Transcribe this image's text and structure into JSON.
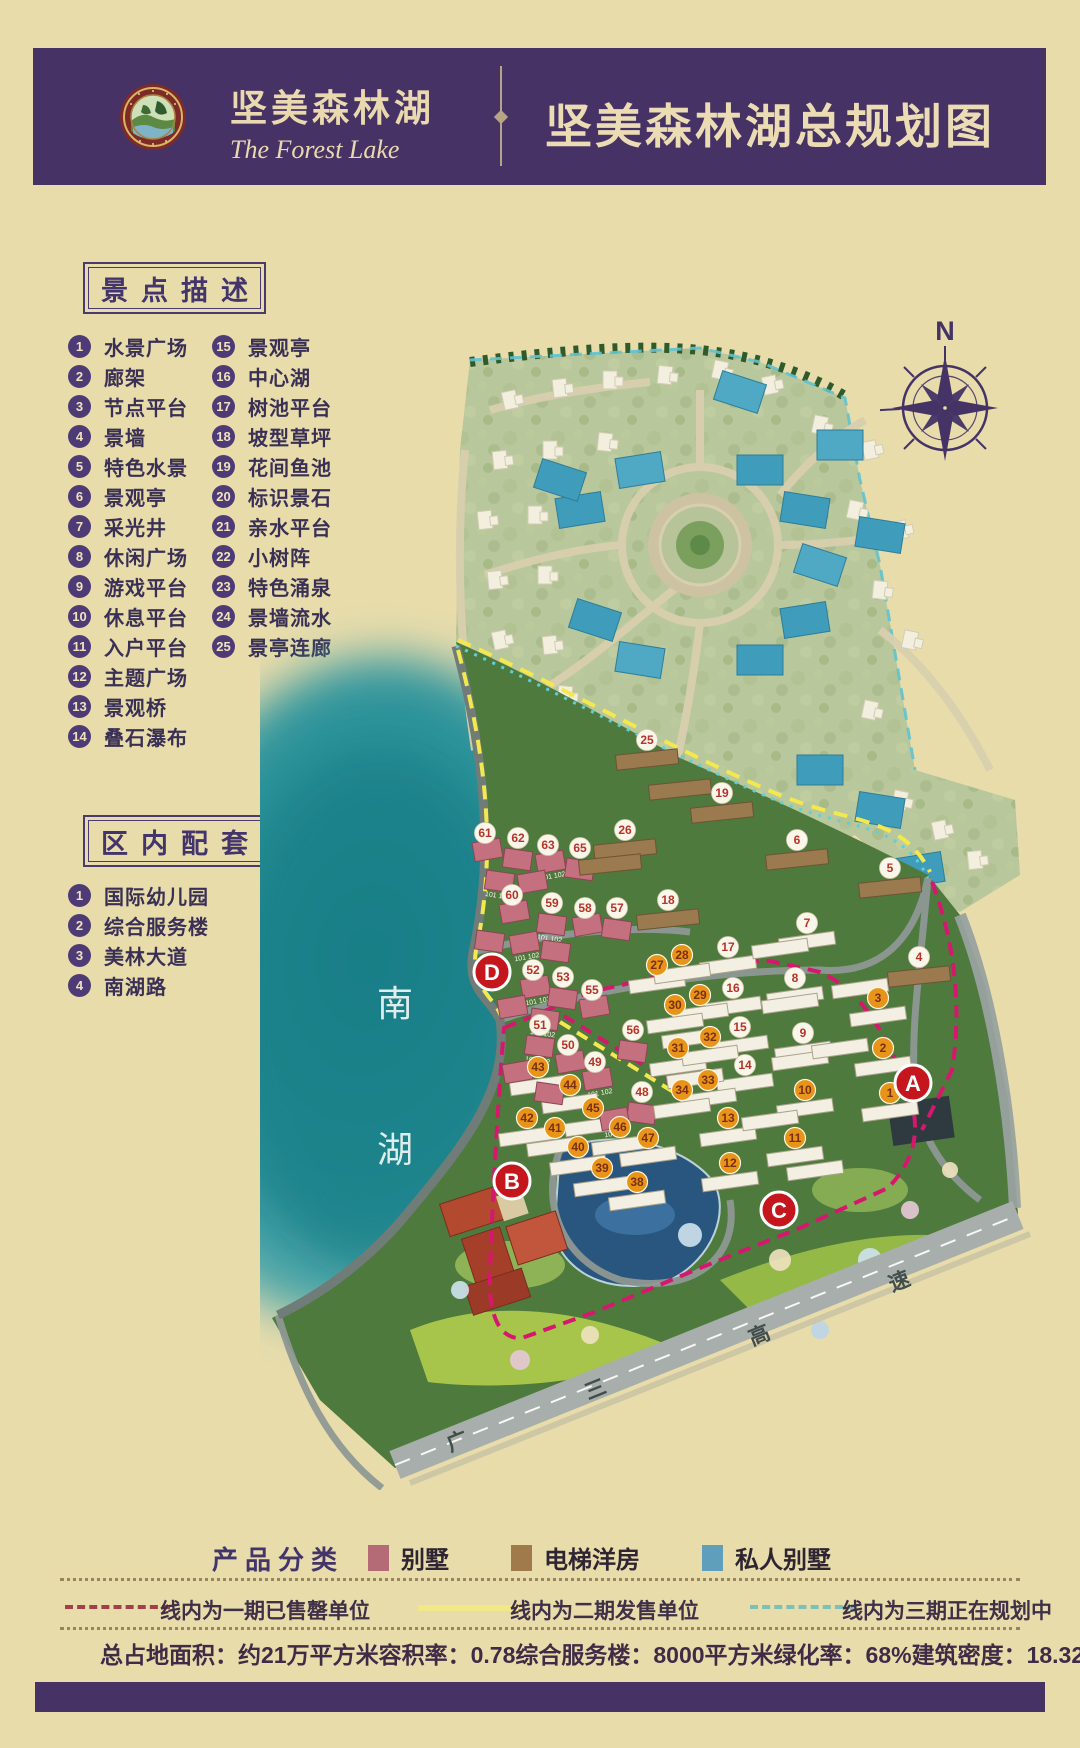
{
  "header": {
    "brand_cn": "坚美森林湖",
    "brand_en": "The Forest Lake",
    "title": "坚美森林湖总规划图"
  },
  "compass": {
    "north_label": "N"
  },
  "scenic": {
    "title": "景点描述",
    "items": [
      {
        "num": "1",
        "label": "水景广场"
      },
      {
        "num": "2",
        "label": "廊架"
      },
      {
        "num": "3",
        "label": "节点平台"
      },
      {
        "num": "4",
        "label": "景墙"
      },
      {
        "num": "5",
        "label": "特色水景"
      },
      {
        "num": "6",
        "label": "景观亭"
      },
      {
        "num": "7",
        "label": "采光井"
      },
      {
        "num": "8",
        "label": "休闲广场"
      },
      {
        "num": "9",
        "label": "游戏平台"
      },
      {
        "num": "10",
        "label": "休息平台"
      },
      {
        "num": "11",
        "label": "入户平台"
      },
      {
        "num": "12",
        "label": "主题广场"
      },
      {
        "num": "13",
        "label": "景观桥"
      },
      {
        "num": "14",
        "label": "叠石瀑布"
      },
      {
        "num": "15",
        "label": "景观亭"
      },
      {
        "num": "16",
        "label": "中心湖"
      },
      {
        "num": "17",
        "label": "树池平台"
      },
      {
        "num": "18",
        "label": "坡型草坪"
      },
      {
        "num": "19",
        "label": "花间鱼池"
      },
      {
        "num": "20",
        "label": "标识景石"
      },
      {
        "num": "21",
        "label": "亲水平台"
      },
      {
        "num": "22",
        "label": "小树阵"
      },
      {
        "num": "23",
        "label": "特色涌泉"
      },
      {
        "num": "24",
        "label": "景墙流水"
      },
      {
        "num": "25",
        "label": "景亭连廊"
      }
    ]
  },
  "amenities": {
    "title": "区内配套",
    "items": [
      {
        "num": "1",
        "label": "国际幼儿园"
      },
      {
        "num": "2",
        "label": "综合服务楼"
      },
      {
        "num": "3",
        "label": "美林大道"
      },
      {
        "num": "4",
        "label": "南湖路"
      }
    ]
  },
  "map": {
    "lake_labels": [
      {
        "char": "南",
        "x": 135,
        "y": 686
      },
      {
        "char": "湖",
        "x": 135,
        "y": 832
      }
    ],
    "highway_labels": [
      {
        "char": "广",
        "x": 200,
        "y": 1118,
        "rot": -22
      },
      {
        "char": "三",
        "x": 338,
        "y": 1066,
        "rot": -22
      },
      {
        "char": "高",
        "x": 502,
        "y": 1012,
        "rot": -22
      },
      {
        "char": "速",
        "x": 642,
        "y": 958,
        "rot": -22
      }
    ],
    "markers": [
      {
        "label": "A",
        "x": 653,
        "y": 753
      },
      {
        "label": "B",
        "x": 252,
        "y": 851
      },
      {
        "label": "C",
        "x": 519,
        "y": 880
      },
      {
        "label": "D",
        "x": 232,
        "y": 642
      }
    ],
    "pink_unit_labels": [
      "101",
      "102"
    ],
    "unit_badges_white": [
      {
        "n": "25",
        "x": 387,
        "y": 410,
        "b": "brown"
      },
      {
        "n": "19",
        "x": 462,
        "y": 463,
        "b": "brown"
      },
      {
        "n": "26",
        "x": 365,
        "y": 500,
        "b": "brown"
      },
      {
        "n": "6",
        "x": 537,
        "y": 510,
        "b": "brown"
      },
      {
        "n": "5",
        "x": 630,
        "y": 538,
        "b": "brown"
      },
      {
        "n": "18",
        "x": 408,
        "y": 570,
        "b": "brown"
      },
      {
        "n": "4",
        "x": 659,
        "y": 627,
        "b": "brown"
      },
      {
        "n": "61",
        "x": 225,
        "y": 503,
        "b": "pink"
      },
      {
        "n": "62",
        "x": 258,
        "y": 508,
        "b": "pink"
      },
      {
        "n": "63",
        "x": 288,
        "y": 515,
        "b": "pink"
      },
      {
        "n": "65",
        "x": 320,
        "y": 518,
        "b": "pink"
      },
      {
        "n": "60",
        "x": 252,
        "y": 565,
        "b": "pink"
      },
      {
        "n": "59",
        "x": 292,
        "y": 573,
        "b": "pink"
      },
      {
        "n": "58",
        "x": 325,
        "y": 578,
        "b": "pink"
      },
      {
        "n": "57",
        "x": 357,
        "y": 578,
        "b": "pink"
      },
      {
        "n": "52",
        "x": 273,
        "y": 640,
        "b": "pink"
      },
      {
        "n": "53",
        "x": 303,
        "y": 647,
        "b": "pink"
      },
      {
        "n": "55",
        "x": 332,
        "y": 660,
        "b": "pink"
      },
      {
        "n": "51",
        "x": 280,
        "y": 695,
        "b": "pink"
      },
      {
        "n": "50",
        "x": 308,
        "y": 715,
        "b": "pink"
      },
      {
        "n": "56",
        "x": 373,
        "y": 700,
        "b": "pink"
      },
      {
        "n": "49",
        "x": 335,
        "y": 732,
        "b": "pink"
      },
      {
        "n": "48",
        "x": 382,
        "y": 762,
        "b": "pink"
      },
      {
        "n": "17",
        "x": 468,
        "y": 617,
        "b": "white"
      },
      {
        "n": "16",
        "x": 473,
        "y": 658,
        "b": "white"
      },
      {
        "n": "15",
        "x": 480,
        "y": 697,
        "b": "white"
      },
      {
        "n": "14",
        "x": 485,
        "y": 735,
        "b": "white"
      },
      {
        "n": "7",
        "x": 547,
        "y": 593,
        "b": "white"
      },
      {
        "n": "8",
        "x": 535,
        "y": 648,
        "b": "white"
      },
      {
        "n": "9",
        "x": 543,
        "y": 703,
        "b": "white"
      }
    ],
    "unit_badges_orange": [
      {
        "n": "27",
        "x": 397,
        "y": 635,
        "b": "white"
      },
      {
        "n": "28",
        "x": 422,
        "y": 625,
        "b": "white"
      },
      {
        "n": "29",
        "x": 440,
        "y": 665,
        "b": "white"
      },
      {
        "n": "30",
        "x": 415,
        "y": 675,
        "b": "white"
      },
      {
        "n": "31",
        "x": 418,
        "y": 718,
        "b": "white"
      },
      {
        "n": "32",
        "x": 450,
        "y": 707,
        "b": "white"
      },
      {
        "n": "33",
        "x": 448,
        "y": 750,
        "b": "white"
      },
      {
        "n": "34",
        "x": 422,
        "y": 760,
        "b": "white"
      },
      {
        "n": "43",
        "x": 278,
        "y": 737,
        "b": "white"
      },
      {
        "n": "44",
        "x": 310,
        "y": 755,
        "b": "white"
      },
      {
        "n": "45",
        "x": 333,
        "y": 778,
        "b": "white"
      },
      {
        "n": "42",
        "x": 267,
        "y": 788,
        "b": "white"
      },
      {
        "n": "41",
        "x": 295,
        "y": 798,
        "b": "white"
      },
      {
        "n": "40",
        "x": 318,
        "y": 817,
        "b": "white"
      },
      {
        "n": "39",
        "x": 342,
        "y": 838,
        "b": "white"
      },
      {
        "n": "38",
        "x": 377,
        "y": 852,
        "b": "white"
      },
      {
        "n": "46",
        "x": 360,
        "y": 797,
        "b": "white"
      },
      {
        "n": "47",
        "x": 388,
        "y": 808,
        "b": "white"
      },
      {
        "n": "10",
        "x": 545,
        "y": 760,
        "b": "white"
      },
      {
        "n": "11",
        "x": 535,
        "y": 808,
        "b": "white"
      },
      {
        "n": "13",
        "x": 468,
        "y": 788,
        "b": "white"
      },
      {
        "n": "12",
        "x": 470,
        "y": 833,
        "b": "white"
      },
      {
        "n": "3",
        "x": 618,
        "y": 668,
        "b": "white"
      },
      {
        "n": "2",
        "x": 623,
        "y": 718,
        "b": "white"
      },
      {
        "n": "1",
        "x": 630,
        "y": 763,
        "b": "white"
      }
    ]
  },
  "legend": {
    "title": "产品分类",
    "items": [
      {
        "label": "别墅",
        "color": "#b56b76"
      },
      {
        "label": "电梯洋房",
        "color": "#a07a4a"
      },
      {
        "label": "私人别墅",
        "color": "#5f9fbc"
      }
    ]
  },
  "phases": [
    {
      "label": "线内为一期已售罄单位",
      "color": "#a04048",
      "style": "dashed",
      "x": 65,
      "label_x": 160
    },
    {
      "label": "线内为二期发售单位",
      "color": "#f2e88a",
      "style": "solid",
      "x": 418,
      "label_x": 510
    },
    {
      "label": "线内为三期正在规划中",
      "color": "#7cc0b8",
      "style": "dashed",
      "x": 750,
      "label_x": 842
    }
  ],
  "stats": [
    {
      "label": "总占地面积",
      "value": "约21万平方米"
    },
    {
      "label": "容积率",
      "value": "0.78"
    },
    {
      "label": "综合服务楼",
      "value": "8000平方米"
    },
    {
      "label": "绿化率",
      "value": "68%"
    },
    {
      "label": "建筑密度",
      "value": "18.32%"
    }
  ]
}
